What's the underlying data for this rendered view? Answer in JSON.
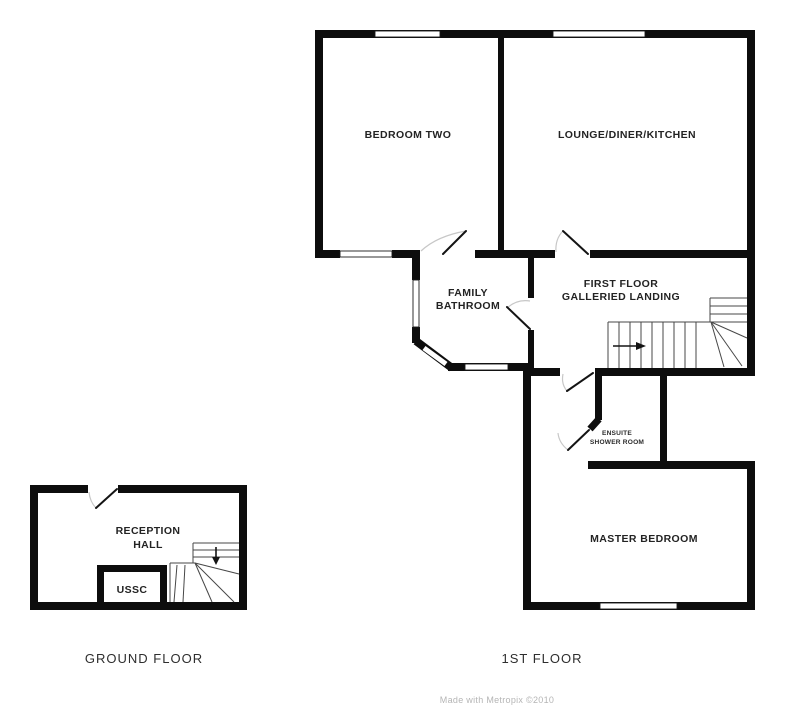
{
  "floor_plan": {
    "type": "property-floor-plan",
    "first_floor": {
      "caption": "1ST FLOOR",
      "rooms": {
        "bedroom_two": {
          "label": "BEDROOM TWO"
        },
        "lounge_diner_kitchen": {
          "label": "LOUNGE/DINER/KITCHEN"
        },
        "family_bathroom": {
          "line1": "FAMILY",
          "line2": "BATHROOM"
        },
        "galleried_landing": {
          "line1": "FIRST FLOOR",
          "line2": "GALLERIED LANDING"
        },
        "ensuite_shower_room": {
          "line1": "ENSUITE",
          "line2": "SHOWER ROOM"
        },
        "master_bedroom": {
          "label": "MASTER BEDROOM"
        }
      },
      "stairs": {
        "direction": "up",
        "arrow_points": "right"
      }
    },
    "ground_floor": {
      "caption": "GROUND FLOOR",
      "rooms": {
        "reception_hall": {
          "line1": "RECEPTION",
          "line2": "HALL"
        },
        "ussc": {
          "label": "USSC"
        }
      },
      "stairs": {
        "direction": "down",
        "arrow_points": "down"
      }
    },
    "credit": "Made with Metropix ©2010",
    "colors": {
      "wall": "#0d0d0d",
      "background": "#ffffff",
      "stair_line": "#474747",
      "door_arc": "#c7c7c7",
      "label": "#232323",
      "watermark": "#b5b5b5"
    }
  }
}
